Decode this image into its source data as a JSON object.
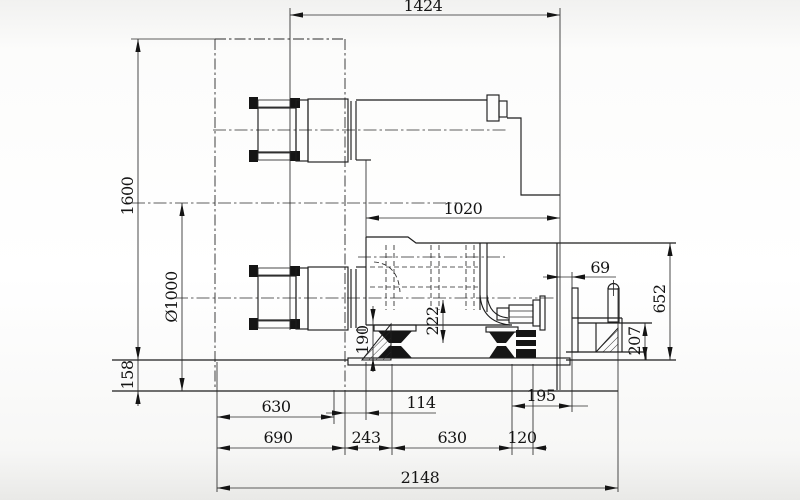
{
  "drawing": {
    "dims": {
      "d1424": "1424",
      "d1600": "1600",
      "d1000": "Ø1000",
      "d158": "158",
      "d1020": "1020",
      "d69": "69",
      "d652": "652",
      "d207": "207",
      "d222": "222",
      "d190": "190",
      "d630a": "630",
      "d114": "114",
      "d690": "690",
      "d243": "243",
      "d630b": "630",
      "d120": "120",
      "d195": "195",
      "d2148": "2148"
    }
  }
}
